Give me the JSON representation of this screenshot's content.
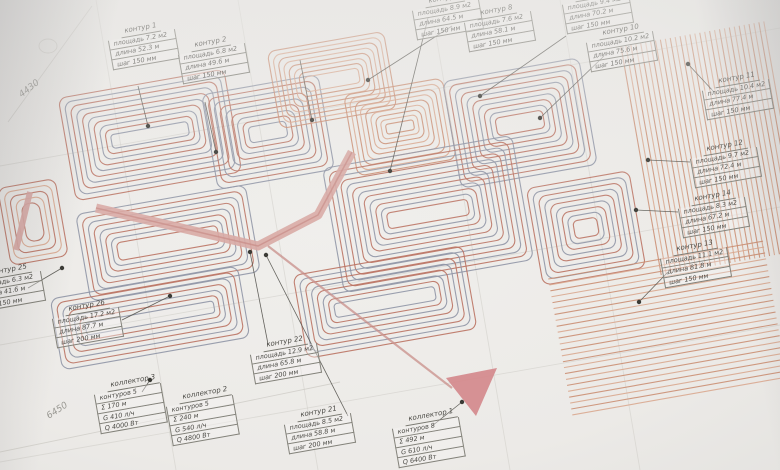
{
  "colors": {
    "pipe_red": "#b96f5e",
    "pipe_blue": "#8d93a4",
    "pipe_orange": "#c98a6d",
    "pipe_orange_light": "#d9a58b",
    "trunk_pink": "#d8a8a4",
    "trunk_pink_dark": "#c98f8a",
    "collector_red": "#d4898c",
    "leader": "#55544e",
    "dot": "#3a3a35",
    "wall": "#cfcdc7"
  },
  "callouts": [
    {
      "id": "k1",
      "title": "контур 1",
      "rows": [
        "площадь 7.2 м2",
        "длина 52.3 м",
        "шаг 150 мм"
      ]
    },
    {
      "id": "k2",
      "title": "контур 2",
      "rows": [
        "площадь 6.8 м2",
        "длина 49.6 м",
        "шаг 150 мм"
      ]
    },
    {
      "id": "k7",
      "title": "контур 7",
      "rows": [
        "площадь 8.9 м2",
        "длина 64.5 м",
        "шаг 150 мм"
      ]
    },
    {
      "id": "k8",
      "title": "контур 8",
      "rows": [
        "площадь 7.6 м2",
        "длина 58.1 м",
        "шаг 150 мм"
      ]
    },
    {
      "id": "k9",
      "title": "контур 9",
      "rows": [
        "площадь 9.4 м2",
        "длина 70.2 м",
        "шаг 150 мм"
      ]
    },
    {
      "id": "k10",
      "title": "контур 10",
      "rows": [
        "площадь 10.2 м2",
        "длина 75.6 м",
        "шаг 150 мм"
      ]
    },
    {
      "id": "k11",
      "title": "контур 11",
      "rows": [
        "площадь 10.4 м2",
        "длина 77.4 м",
        "шаг 150 мм"
      ]
    },
    {
      "id": "k12",
      "title": "контур 12",
      "rows": [
        "площадь 9.7 м2",
        "длина 72.4 м",
        "шаг 150 мм"
      ]
    },
    {
      "id": "k14",
      "title": "контур 14",
      "rows": [
        "площадь 8.3 м2",
        "длина 67.2 м",
        "шаг 150 мм"
      ]
    },
    {
      "id": "k13",
      "title": "контур 13",
      "rows": [
        "площадь 11.1 м2",
        "длина 81.8 м",
        "шаг 150 мм"
      ]
    },
    {
      "id": "k25",
      "title": "контур 25",
      "rows": [
        "площадь 6.3 м2",
        "длина 41.6 м",
        "шаг 150 мм"
      ]
    },
    {
      "id": "k26",
      "title": "контур 26",
      "rows": [
        "площадь 17.2 м2",
        "длина 87.7 м",
        "шаг 200 мм"
      ]
    },
    {
      "id": "k22",
      "title": "контур 22",
      "rows": [
        "площадь 12.9 м2",
        "длина 65.8 м",
        "шаг 200 мм"
      ]
    },
    {
      "id": "k21",
      "title": "контур 21",
      "rows": [
        "площадь 8.5 м2",
        "длина 58.8 м",
        "шаг 200 мм"
      ]
    },
    {
      "id": "col3",
      "title": "коллектор 3",
      "rows": [
        "контуров 5",
        "Σ 170 м",
        "G 410 л/ч",
        "Q 4000 Вт"
      ]
    },
    {
      "id": "col2",
      "title": "коллектор 2",
      "rows": [
        "контуров 5",
        "Σ 240 м",
        "G 540 л/ч",
        "Q 4800 Вт"
      ]
    },
    {
      "id": "col1",
      "title": "коллектор 1",
      "rows": [
        "контуров 8",
        "Σ 492 м",
        "G 610 л/ч",
        "Q 6400 Вт"
      ]
    }
  ],
  "dimensions": [
    {
      "id": "dim-left",
      "label": "4430"
    },
    {
      "id": "dim-bottom",
      "label": "6450"
    }
  ]
}
